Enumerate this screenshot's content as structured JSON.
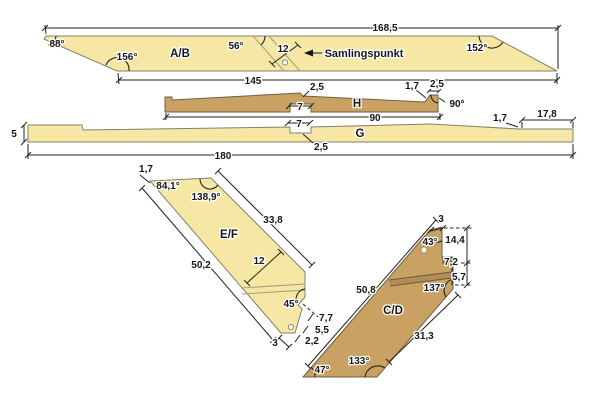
{
  "colors": {
    "pale_wood": "#f6e8a4",
    "tan_wood": "#c9a263",
    "dimension": "#20201e",
    "background": "#ffffff"
  },
  "parts": {
    "ab": {
      "name": "A/B",
      "top_length": "168,5",
      "bottom_length": "145",
      "angle_top_left": "88°",
      "angle_bottom_left": "156°",
      "angle_joint": "56°",
      "angle_top_right": "152°",
      "joint_width": "12",
      "joint_note": "Samlingspunkt"
    },
    "h": {
      "name": "H",
      "length": "90",
      "top_step": "2,5",
      "right_rise": "1,7",
      "right_width": "2,5",
      "right_angle": "90°",
      "notch_width": "7"
    },
    "g": {
      "name": "G",
      "length": "180",
      "thickness": "5",
      "notch_width": "7",
      "notch_depth": "2,5",
      "step_depth": "1,7",
      "end_length": "17,8"
    },
    "ef": {
      "name": "E/F",
      "tip_cut": "1,7",
      "angle_tip": "84,1°",
      "angle_top": "138,9°",
      "edge_right": "33,8",
      "edge_left": "50,2",
      "width": "12",
      "notch_angle": "45°",
      "dim_a": "7,7",
      "dim_b": "5,5",
      "dim_c": "2,2",
      "bottom_width": "3"
    },
    "cd": {
      "name": "C/D",
      "top_cut": "3",
      "angle_top": "43°",
      "height_total": "14,4",
      "height_mid": "7,2",
      "height_low": "5,7",
      "angle_step": "137°",
      "edge_left": "50,8",
      "edge_lower_right": "31,3",
      "angle_bottom_right": "133°",
      "angle_bottom_left": "47°"
    }
  }
}
